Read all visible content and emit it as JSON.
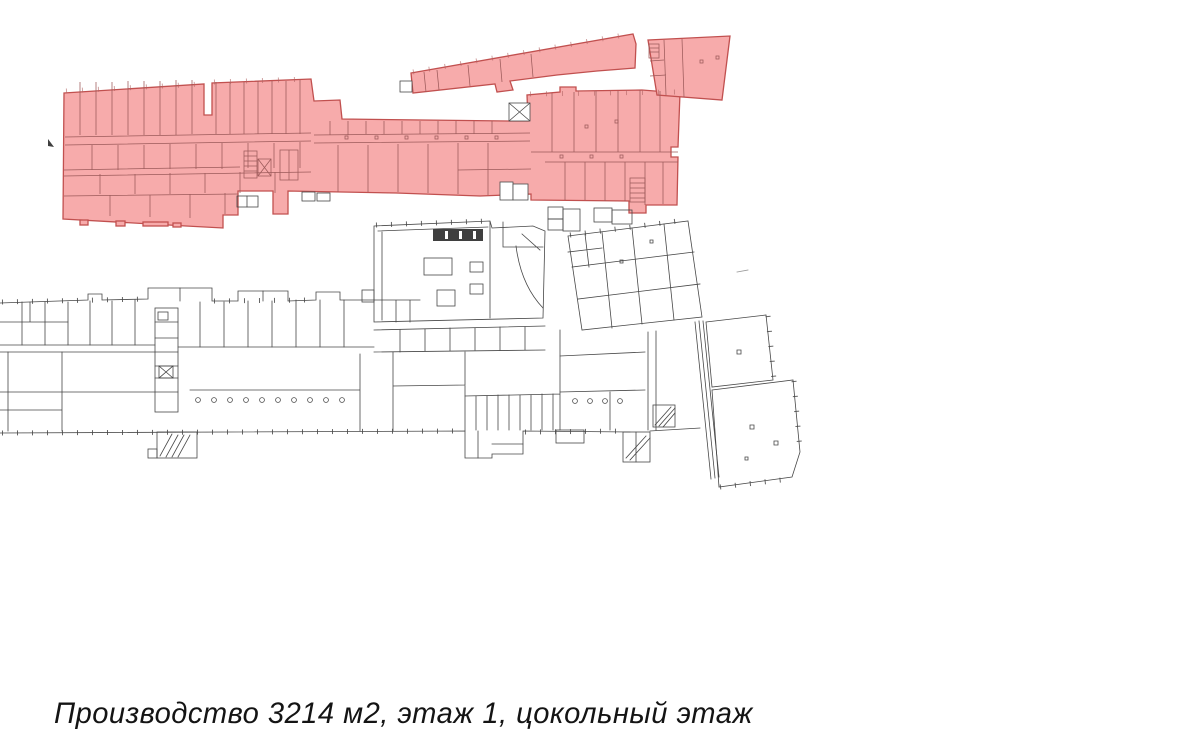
{
  "caption": {
    "text": "Производство 3214 м2, этаж 1, цокольный этаж"
  },
  "highlight": {
    "label": "Производство",
    "area_m2": "3214",
    "floor_note": "этаж 1, цокольный этаж"
  },
  "colors": {
    "highlight_fill": "#f7abab",
    "highlight_stroke": "#c1504f",
    "highlight_inner_line": "#9c5a5a",
    "plan_line": "#474747",
    "tick_line": "#4a4a4a",
    "background": "#ffffff",
    "caption_text": "#141414"
  }
}
